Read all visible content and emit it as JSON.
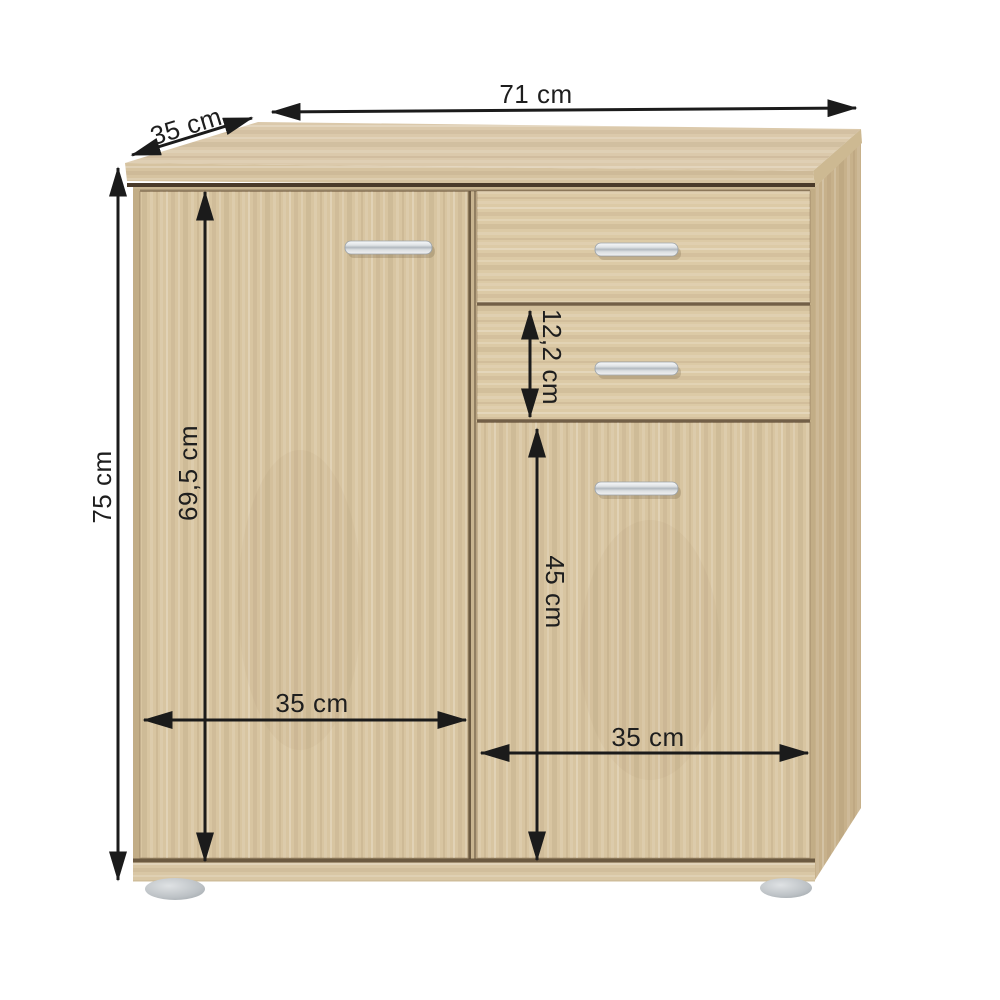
{
  "diagram": {
    "type": "furniture-dimension-diagram",
    "dimensions": {
      "width": "71 cm",
      "depth": "35 cm",
      "height": "75 cm",
      "left_door_height": "69,5 cm",
      "drawer_height": "12,2 cm",
      "right_door_height": "45 cm",
      "left_door_width": "35 cm",
      "right_door_width": "35 cm"
    },
    "colors": {
      "background": "#ffffff",
      "arrow": "#1b1b1b",
      "text": "#1e1e1e",
      "wood_top": "#dbc9ab",
      "wood_band": "#d6c3a0",
      "wood_side": "#c7b18b",
      "wood_side_edge": "#cdb992",
      "wood_carcass": "#c9b590",
      "wood_front": "#d8c5a1",
      "wood_drawer": "#dccaa6",
      "wood_plinth": "#d9c7a5",
      "wood_edge": "#c2ad86",
      "gap": "#5c4a34",
      "slab_shadow": "#4a3a29",
      "handle_light": "#eef0f1",
      "handle_dark": "#aeb5bb",
      "foot": "#b9bec2"
    }
  }
}
